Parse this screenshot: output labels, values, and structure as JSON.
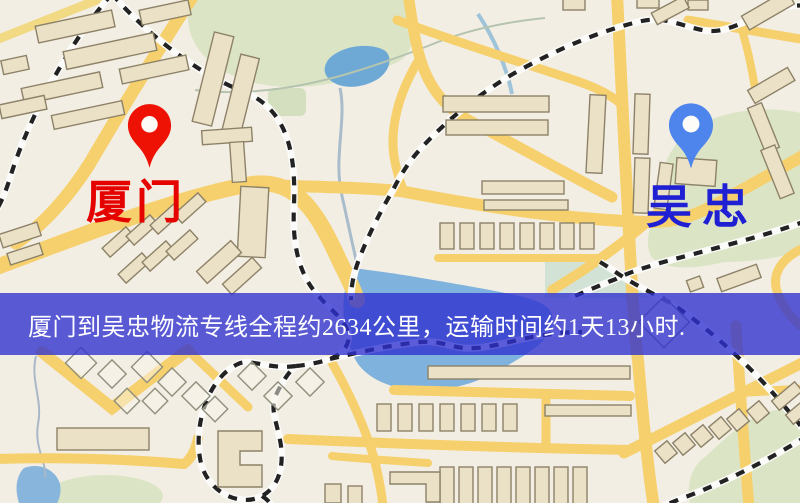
{
  "page": {
    "kind": "logistics-route-map",
    "width_px": 800,
    "height_px": 503
  },
  "origin": {
    "label": "厦门",
    "pin": "red-map-pin",
    "pin_color": "#ee1205",
    "label_color": "#e50300"
  },
  "destination": {
    "label": "吴忠",
    "pin": "blue-map-pin",
    "pin_color": "#4e85ec",
    "label_color": "#1f1fd3"
  },
  "banner": {
    "text": "厦门到吴忠物流专线全程约2634公里，运输时间约1天13小时.",
    "distance_km": "2634",
    "duration": "1天13小时",
    "background_color": "#2e30d0",
    "text_color": "#ffffff"
  },
  "map_colors": {
    "background": "#f3eee4",
    "road": "#f6d06c",
    "road_minor": "#f2d983",
    "park": "#dbe5c6",
    "wetland": "#d2e2d4",
    "water": "#7fb2dc",
    "building_fill": "#eae1c6",
    "building_stroke": "#8d8268",
    "railway": "#222222",
    "railway_casing": "#fbfbf9"
  }
}
